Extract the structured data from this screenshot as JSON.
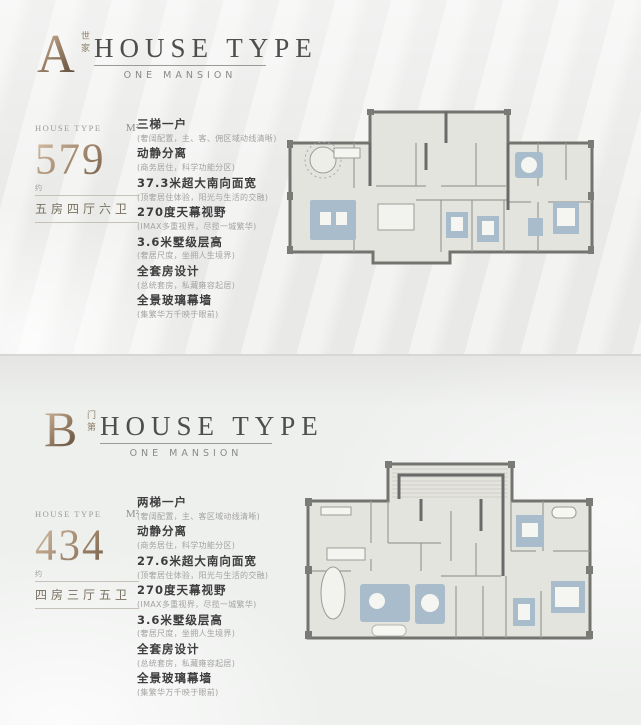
{
  "colors": {
    "background": "#edeeec",
    "bronze_accent": "#9b8168",
    "heading_text": "#4e4e4c",
    "subheading_text": "#8a8a88",
    "feature_title_text": "#3d3d3d",
    "feature_desc_text": "#a3a3a1",
    "plan_wall": "#73736f",
    "plan_floor": "#e4e4de",
    "plan_furniture": "#a9bccb"
  },
  "panels": [
    {
      "letter": "A",
      "letter_tag": "世家",
      "title": "HOUSE TYPE",
      "subtitle": "ONE MANSION",
      "stats": {
        "label": "HOUSE TYPE",
        "unit": "M²",
        "value": "579",
        "approx": "约",
        "config": "五房四厅六卫"
      },
      "features": [
        {
          "title": "三梯一户",
          "desc": "(奢阔配置，主、客、佣区域动线清晰)"
        },
        {
          "title": "动静分离",
          "desc": "(商务居住，科学功能分区)"
        },
        {
          "title": "37.3米超大南向面宽",
          "desc": "(顶奢居住体验，阳光与生活的交融)"
        },
        {
          "title": "270度天幕视野",
          "desc": "(IMAX多重视界，尽揽一城繁华)"
        },
        {
          "title": "3.6米墅级层高",
          "desc": "(奢居尺度，坐拥人生境界)"
        },
        {
          "title": "全套房设计",
          "desc": "(总统套房，私藏雍容起居)"
        },
        {
          "title": "全景玻璃幕墙",
          "desc": "(集繁华万千映于眼前)"
        }
      ]
    },
    {
      "letter": "B",
      "letter_tag": "门第",
      "title": "HOUSE TYPE",
      "subtitle": "ONE MANSION",
      "stats": {
        "label": "HOUSE TYPE",
        "unit": "M²",
        "value": "434",
        "approx": "约",
        "config": "四房三厅五卫"
      },
      "features": [
        {
          "title": "两梯一户",
          "desc": "(奢阔配置，主、客区域动线清晰)"
        },
        {
          "title": "动静分离",
          "desc": "(商务居住，科学功能分区)"
        },
        {
          "title": "27.6米超大南向面宽",
          "desc": "(顶奢居住体验，阳光与生活的交融)"
        },
        {
          "title": "270度天幕视野",
          "desc": "(IMAX多重视界，尽揽一城繁华)"
        },
        {
          "title": "3.6米墅级层高",
          "desc": "(奢居尺度，坐拥人生境界)"
        },
        {
          "title": "全套房设计",
          "desc": "(总统套房，私藏雍容起居)"
        },
        {
          "title": "全景玻璃幕墙",
          "desc": "(集繁华万千映于眼前)"
        }
      ]
    }
  ]
}
